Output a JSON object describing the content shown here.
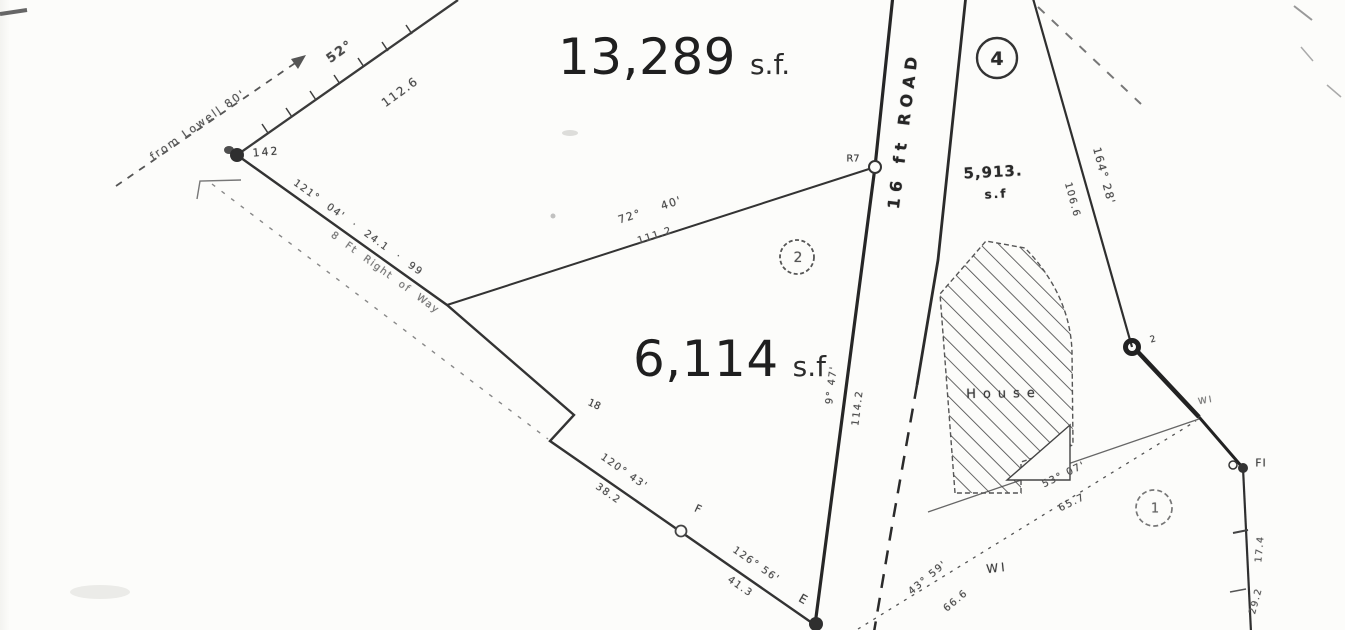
{
  "plat": {
    "areas": {
      "top": {
        "value": "13,289",
        "unit": "s.f."
      },
      "lot2": {
        "value": "6,114",
        "unit": "s.f"
      },
      "lot4": {
        "value": "5,913.",
        "unit": "s.f"
      }
    },
    "road_name": "16 ft ROAD",
    "house_label": "House",
    "lot_circles": {
      "one": "1",
      "two": "2",
      "four": "4"
    },
    "annotations": {
      "from_lowell": "from Lowell 80'",
      "bearing_52": "52°",
      "dist_112_6": "112.6",
      "bearing_121": "121° 04' · 24.1 · 99",
      "right_of_way": "8 Ft Right of Way",
      "bearing_72": "72° 40'",
      "dist_111_2": "111.2",
      "bearing_164": "164° 28'",
      "dist_106_6": "106.6",
      "bearing_road": "9° 47'",
      "dist_114_2": "114.2",
      "bearing_120": "120° 43'",
      "dist_38_2": "38.2",
      "bearing_126": "126° 56'",
      "dist_41_3": "41.3",
      "bearing_53": "53° 07'",
      "dist_65_7": "65.7",
      "bearing_43": "43° 59'",
      "dist_66_6": "66.6",
      "dist_17_4": "17.4",
      "dist_29_2": "29.2"
    },
    "point_labels": {
      "p142": "142",
      "pR7": "R7",
      "p18": "18",
      "pF": "F",
      "pE": "E",
      "p2": "2",
      "pFI": "FI",
      "wi_a": "WI",
      "wi_b": "WI"
    }
  }
}
